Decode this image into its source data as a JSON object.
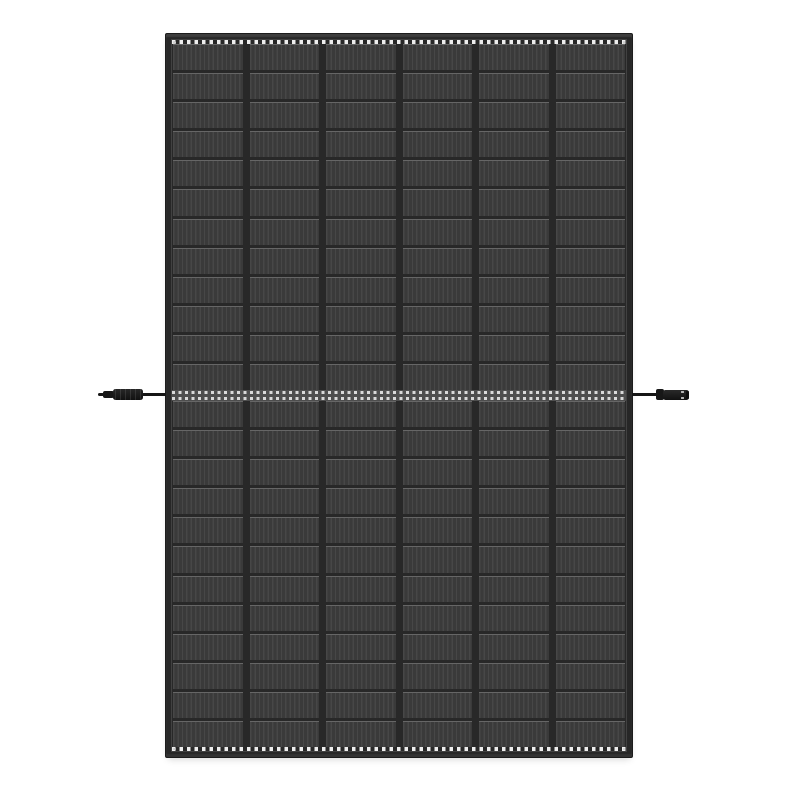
{
  "scene": {
    "description": "Product photo of a black-frame monocrystalline solar panel on a white background, portrait orientation, with two side cables and MC4 connectors exiting at mid-height",
    "background_color": "#ffffff"
  },
  "panel": {
    "orientation": "portrait",
    "columns": 6,
    "rows_per_half": 12,
    "total_cell_rows": 24,
    "busbars": {
      "count": 5,
      "dot_fractions": [
        0.25,
        0.5,
        0.75
      ],
      "large_pad_indices": [
        1,
        3
      ],
      "large_pad_size": 8,
      "small_pad_size": 5,
      "mid_pad_size": 6
    },
    "colors": {
      "background": "#ffffff",
      "frame": "#272727",
      "frame_edge": "#1c1c1c",
      "gap": "#282828",
      "cell": "#3a3a3a",
      "stripe": "#474747",
      "cell_top": "#666666",
      "busbar": "#f1f1f1",
      "dash": "#ededed",
      "mid_base": "#4e4e4e",
      "mid_dash": "#d9d9d9",
      "cable": "#161616",
      "connector": "#171717"
    }
  },
  "connectors": {
    "left": {
      "type": "mc4-male-tip",
      "side": "left"
    },
    "right": {
      "type": "mc4-female-coupler",
      "side": "right"
    }
  }
}
